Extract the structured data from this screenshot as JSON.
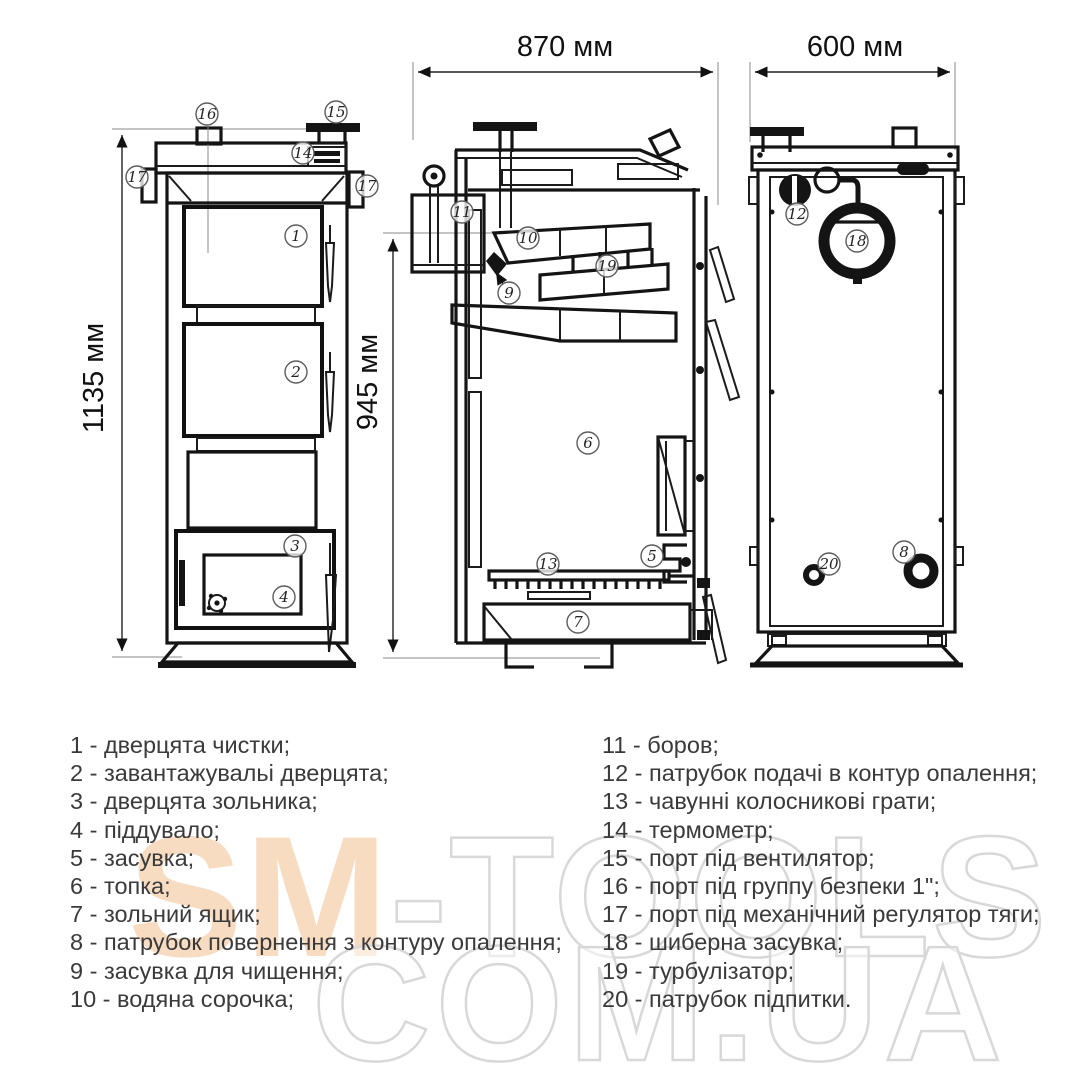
{
  "dims": {
    "side_width": "870 мм",
    "back_width": "600 мм",
    "front_height": "1135 мм",
    "side_height": "945 мм"
  },
  "callouts": {
    "c1": "1",
    "c2": "2",
    "c3": "3",
    "c4": "4",
    "c5": "5",
    "c6": "6",
    "c7": "7",
    "c8": "8",
    "c9": "9",
    "c10": "10",
    "c11": "11",
    "c12": "12",
    "c13": "13",
    "c14": "14",
    "c15": "15",
    "c16": "16",
    "c17": "17",
    "c18": "18",
    "c19": "19",
    "c20": "20"
  },
  "legend": {
    "left": [
      "1 - дверцята чистки;",
      "2 - завантажувальі дверцята;",
      "3 - дверцята зольника;",
      "4 - піддувало;",
      "5 - засувка;",
      "6 - топка;",
      "7 - зольний ящик;",
      "8 - патрубок повернення з контуру опалення;",
      "9 - засувка для чищення;",
      "10 - водяна сорочка;"
    ],
    "right": [
      "11 - боров;",
      "12 - патрубок подачі в контур опалення;",
      "13 - чавунні колосникові грати;",
      "14 - термометр;",
      "15 - порт під вентилятор;",
      "16 - порт під группу безпеки 1\";",
      "17 - порт під механічний регулятор тяги;",
      "18 - шиберна засувка;",
      "19 - турбулізатор;",
      "20 - патрубок підпитки."
    ]
  },
  "watermark": {
    "sm": "SM",
    "tools": "-TOOLS",
    "site": "COM.UA"
  }
}
